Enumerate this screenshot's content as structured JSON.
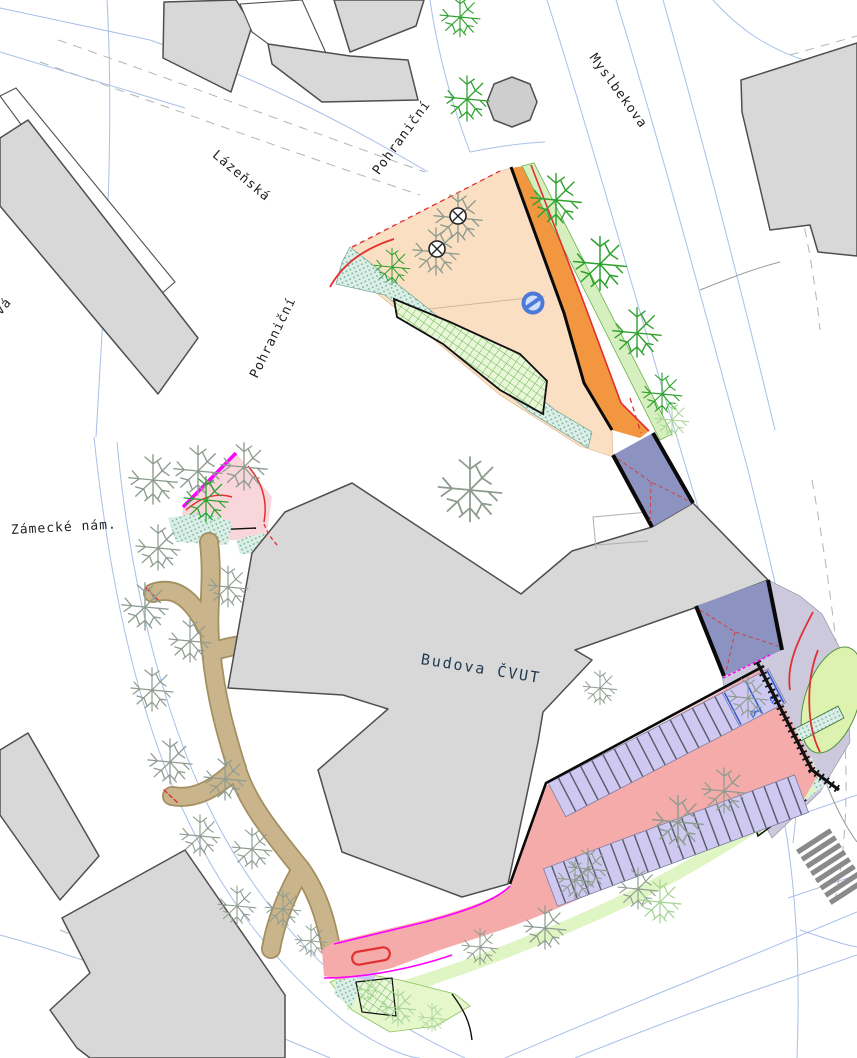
{
  "labels": {
    "street_lazenska": "Lázeňská",
    "street_pohranicni_upper": "Pohraniční",
    "street_pohranicni_lower": "Pohraniční",
    "street_myslbekova": "Myslbekova",
    "square_zamecke": "Zámecké nám.",
    "street_partial_west": "vá",
    "building_cvut": "Budova ČVUT"
  },
  "symbols": {
    "wheelchair": "♿",
    "no_entry_sign": "no-entry-roundel",
    "tree_removal_marker": "circled-x",
    "pedestrian_crossing": "zebra-stripes"
  },
  "colors": {
    "building_fill": "#d8d8d8",
    "building_outline": "#4f4f4f",
    "parcel_line_blue": "#a8c0e8",
    "surface_peach": "#fbdfc2",
    "path_orange": "#f2973f",
    "lawn_green": "#e3f6c8",
    "grass_teal": "#d9ece6",
    "road_pink": "#f6abab",
    "parking_lavender": "#cfc9f2",
    "passage_blue": "#8d93c0",
    "plaza_gray": "#ccc9dc",
    "trail_tan": "#c9b48c",
    "accent_magenta": "#ff00ff",
    "accent_red": "#e03030",
    "tree_green": "#2ea12e",
    "tree_gray": "#8e9c90",
    "label_navy": "#203a54"
  }
}
